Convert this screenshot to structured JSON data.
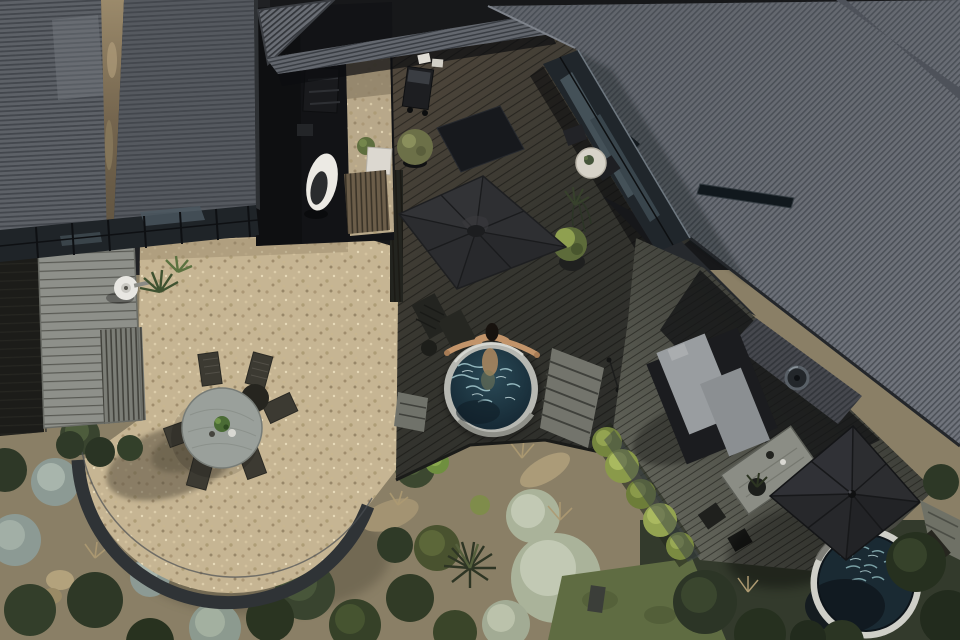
{
  "scene": {
    "title": "Aerial drone photograph of a modern black-clad house with courtyards, plunge pool and native garden",
    "description": "Top-down view: charcoal corrugated metal roofs at top-left and right with a stained valley gutter and glass conservatory band; a narrow service courtyard with hanging egg chair, timber screen fence and white cabinet; a tan gravel dining courtyard with round weathered-timber table, six slatted chairs and a curved charcoal timber edge; a black timber pool deck with two square charcoal cantilever umbrellas, loungers, barbecue and planters; a round plunge pool with pale rim where a swimmer floats with arms spread on the edge; a weathered timber platform with outdoor shower fixture and flax plants; a right-hand deck with grey-cushioned daybed, chimney flue, weathered outdoor table and a second round hot tub with sparkling water partly shaded by an umbrella; gardens of sage, silver-blue and dark green mounded shrubs, tan rocks, grasses and an olive lawn.",
    "objects": [
      {
        "name": "corrugated-roof-left",
        "note": "dark grey corrugated roof, two planes with tan-stained valley"
      },
      {
        "name": "conservatory-glass",
        "note": "dark glass skylight band along roof eave"
      },
      {
        "name": "service-courtyard",
        "note": "gravel strip, white egg chair, timber slat fence, white cabinet, potted plant"
      },
      {
        "name": "barbecue",
        "note": "black grill with white pillows beside it"
      },
      {
        "name": "pool-deck",
        "note": "black diagonal timber boards"
      },
      {
        "name": "patio-umbrella-1",
        "note": "large square charcoal umbrella over loungers"
      },
      {
        "name": "plunge-pool",
        "note": "round pool, pale rim, dark teal sparkling water"
      },
      {
        "name": "swimmer",
        "note": "person with dark hair, arms spread resting on pool rim"
      },
      {
        "name": "dining-courtyard",
        "note": "tan gravel, round weathered table, six dark slatted chairs, green centrepiece"
      },
      {
        "name": "patio-edge-arc",
        "note": "curved charcoal timber edging around gravel circle"
      },
      {
        "name": "outdoor-shower-platform",
        "note": "weathered grey planks, white round fixture, steps, flax plants"
      },
      {
        "name": "corrugated-roof-right",
        "note": "large diagonal corrugated roof with ridge seam and glass window band"
      },
      {
        "name": "bistro-set",
        "note": "small pale round table with plant and two dark chairs"
      },
      {
        "name": "daybed",
        "note": "dark frame with two light grey cushions"
      },
      {
        "name": "chimney-flue",
        "note": "round metal flue on dark roof"
      },
      {
        "name": "outdoor-table",
        "note": "weathered rectangular table with dark chairs and potted plant"
      },
      {
        "name": "patio-umbrella-2",
        "note": "square charcoal umbrella shading hot tub corner"
      },
      {
        "name": "hot-tub",
        "note": "round tub, white rim, sparkling teal water, navy shadowed half"
      },
      {
        "name": "garden",
        "note": "sage and silver-blue mounds, dark green shrubs, palm-like grass, tan rocks, olive lawn"
      }
    ]
  },
  "palette": {
    "roof_left_lit": "#5d6167",
    "roof_left_line": "#43474d",
    "valley_stain": "#8d7c5f",
    "conservatory_glass": "#1f2428",
    "glass_reflection": "#4b5860",
    "roof_right_base": "#5f636a",
    "roof_right_lit": "#70747c",
    "corrugation_line": "#474b52",
    "entry_roof": "#6a6e75",
    "deck_lit": "#53493d",
    "deck_dark": "#2b2c29",
    "deck_weathered": "#71736a",
    "board_line": "#1f201d",
    "gravel_base": "#c6b593",
    "gravel_dark": "#a5916f",
    "gravel_light": "#e2d3b0",
    "patio_edge": "#2f3336",
    "table_wood": "#9aa09b",
    "chair_wood": "#3c3a32",
    "centerpiece_green": "#4a6b35",
    "umbrella_canopy": "#2b2c2f",
    "umbrella_seam": "#1a1b1d",
    "pool_rim": "#b7b8b2",
    "water_deep": "#132430",
    "water_mid": "#2b4a57",
    "water_sparkle": "#9fc3c9",
    "skin": "#c2946a",
    "hair": "#17120e",
    "egg_chair": "#eceae4",
    "white_furniture": "#dcd8d0",
    "fence_timber": "#6b5d49",
    "cushion_gray": "#999da0",
    "daybed_frame": "#1b1c1f",
    "flue_metal": "#596067",
    "sage_base": "#aab39a",
    "sage_light": "#c2c9b4",
    "dark_green": "#39442f",
    "mid_green": "#4d5c3c",
    "yellow_green": "#8a9a4a",
    "olive_lawn": "#5f6c42",
    "grass_tan": "#ad9a72",
    "rock_tan": "#b3a27c",
    "soil_mulch": "#8a7f66",
    "tub_rim": "#cfcfc8",
    "tub_water": "#1a2a33",
    "tub_sparkle": "#7fa6ab"
  }
}
